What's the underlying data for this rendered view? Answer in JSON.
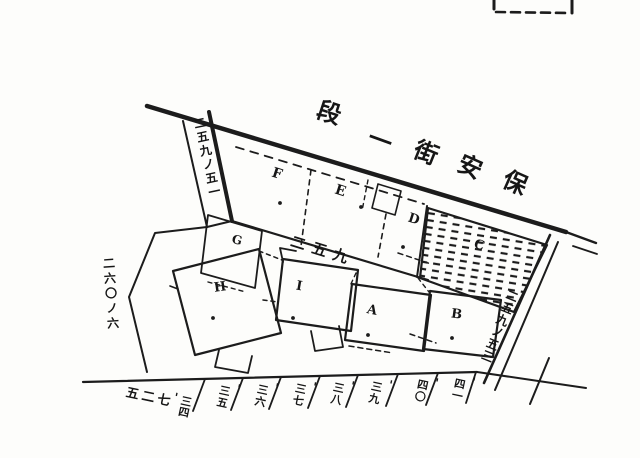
{
  "colors": {
    "ink": "#1c1c1c",
    "paper": "#fdfdfb"
  },
  "street": {
    "name_read_right_to_left": "保安街一段",
    "chars": [
      "段",
      "一",
      "街",
      "安",
      "保"
    ]
  },
  "block": {
    "number": "二五九"
  },
  "plots": [
    {
      "label": "F"
    },
    {
      "label": "E"
    },
    {
      "label": "D"
    },
    {
      "label": "G"
    },
    {
      "label": "C"
    },
    {
      "label": "H"
    },
    {
      "label": "I"
    },
    {
      "label": "A"
    },
    {
      "label": "B"
    }
  ],
  "side_labels": {
    "upper_left_strip": "二五九ノ五一",
    "left_boundary": "二六〇ノ六",
    "right_boundary": "二五九ノ五三"
  },
  "bottom_lots": {
    "first": {
      "block": "五二七",
      "mark": "'",
      "number": "三四"
    },
    "mark": "'",
    "numbers": [
      "三五",
      "三六",
      "三七",
      "三八",
      "三九",
      "四〇",
      "四一"
    ]
  }
}
